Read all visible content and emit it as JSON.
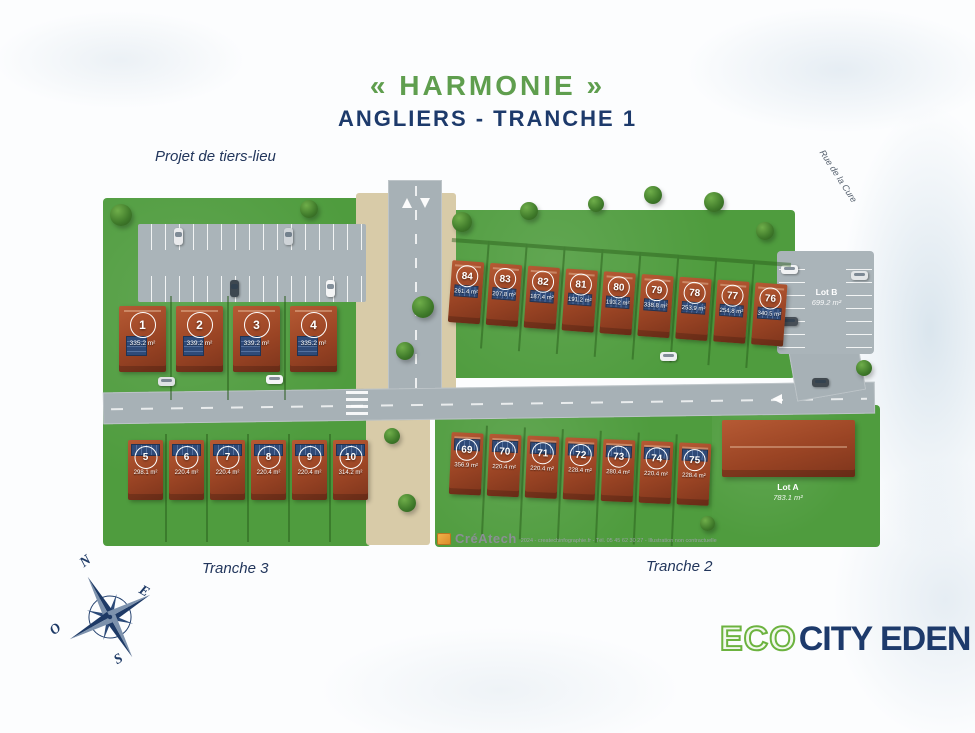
{
  "title": {
    "main": "« HARMONIE »",
    "sub": "Angliers - Tranche 1"
  },
  "labels": {
    "tiers_lieu": "Projet de tiers-lieu",
    "tranche3": "Tranche 3",
    "tranche2": "Tranche 2",
    "rue": "Rue de la Cure",
    "lot_a": {
      "name": "Lot A",
      "area": "783.1 m²"
    },
    "lot_b": {
      "name": "Lot B",
      "area": "699.2 m²"
    }
  },
  "compass": {
    "n": "N",
    "e": "E",
    "s": "S",
    "o": "O"
  },
  "lots": {
    "row_left": [
      {
        "num": "1",
        "area": "335.2 m²"
      },
      {
        "num": "2",
        "area": "339.2 m²"
      },
      {
        "num": "3",
        "area": "339.2 m²"
      },
      {
        "num": "4",
        "area": "335.2 m²"
      }
    ],
    "row_top_right": [
      {
        "num": "84",
        "area": "261.4 m²"
      },
      {
        "num": "83",
        "area": "207.8 m²"
      },
      {
        "num": "82",
        "area": "187.4 m²"
      },
      {
        "num": "81",
        "area": "191.2 m²"
      },
      {
        "num": "80",
        "area": "193.2 m²"
      },
      {
        "num": "79",
        "area": "338.8 m²"
      },
      {
        "num": "78",
        "area": "253.9 m²"
      },
      {
        "num": "77",
        "area": "254.8 m²"
      },
      {
        "num": "76",
        "area": "340.5 m²"
      }
    ],
    "row_bottom_left": [
      {
        "num": "5",
        "area": "298.1 m²"
      },
      {
        "num": "6",
        "area": "220.4 m²"
      },
      {
        "num": "7",
        "area": "220.4 m²"
      },
      {
        "num": "8",
        "area": "220.4 m²"
      },
      {
        "num": "9",
        "area": "220.4 m²"
      },
      {
        "num": "10",
        "area": "314.2 m²"
      }
    ],
    "row_bottom_mid": [
      {
        "num": "69",
        "area": "356.9 m²"
      },
      {
        "num": "70",
        "area": "220.4 m²"
      },
      {
        "num": "71",
        "area": "220.4 m²"
      },
      {
        "num": "72",
        "area": "228.4 m²"
      },
      {
        "num": "73",
        "area": "280.4 m²"
      },
      {
        "num": "74",
        "area": "220.4 m²"
      },
      {
        "num": "75",
        "area": "228.4 m²"
      }
    ]
  },
  "credit": {
    "brand": "CréAtech",
    "text": "2024 - createchinfographie.fr - Tél. 05 45 62 30 27 - Illustration non contractuelle"
  },
  "logo": {
    "eco": "ECO",
    "city": "CITY EDEN"
  },
  "colors": {
    "title_green": "#5f9e4e",
    "navy": "#1d3a6b",
    "map_green": "#4f9c3e",
    "brick": "#9a4424",
    "road_gray": "#a7b1b6",
    "sand": "#d8cba8",
    "solar_panel": "#2e4a78",
    "logo_green": "#6cb33f"
  }
}
